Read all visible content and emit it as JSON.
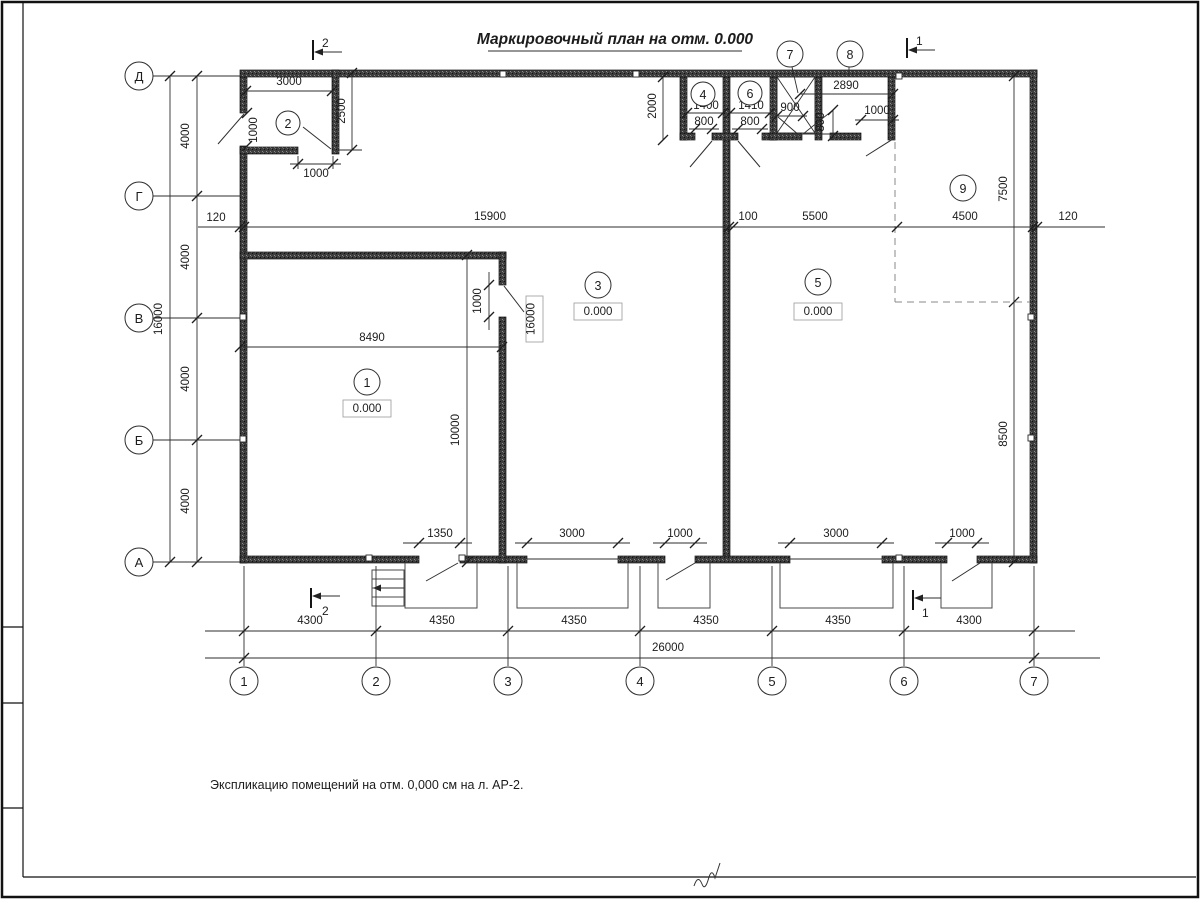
{
  "title": "Маркировочный план на отм. 0.000",
  "note": "Экспликацию помещений на отм. 0,000 см на л. АР-2.",
  "row_axes": [
    "Д",
    "Г",
    "В",
    "Б",
    "А"
  ],
  "col_axes": [
    "1",
    "2",
    "3",
    "4",
    "5",
    "6",
    "7"
  ],
  "rooms": {
    "r1": {
      "num": "1",
      "elev": "0.000"
    },
    "r2": {
      "num": "2"
    },
    "r3": {
      "num": "3",
      "elev": "0.000"
    },
    "r4": {
      "num": "4"
    },
    "r5": {
      "num": "5",
      "elev": "0.000"
    },
    "r6": {
      "num": "6"
    },
    "r7": {
      "num": "7"
    },
    "r8": {
      "num": "8"
    },
    "r9": {
      "num": "9"
    }
  },
  "sections": {
    "top_2": "2",
    "top_1": "1",
    "bottom_2": "2",
    "bottom_1": "1"
  },
  "dims": {
    "room2_width": "3000",
    "room2_depth": "2500",
    "left_wall_door": "1000",
    "room2_door": "1000",
    "top_rooms_depth": "2000",
    "room4_width": "1400",
    "room4_door": "800",
    "room6_width": "1410",
    "room6_door": "800",
    "shaft_door": "900",
    "ramp": "800",
    "room8_width": "2890",
    "room8_door": "1000",
    "room9_depth": "7500",
    "mid": [
      "120",
      "15900",
      "100",
      "5500",
      "4500",
      "120"
    ],
    "left_spans": [
      "4000",
      "4000",
      "4000",
      "4000"
    ],
    "left_total": "16000",
    "room1_width": "8490",
    "room1_door": "1000",
    "room1_depth": "10000",
    "wall_mark": "16000",
    "right_span": "8500",
    "doors": [
      "1350",
      "3000",
      "1000",
      "3000",
      "1000"
    ],
    "bottom_spans": [
      "4300",
      "4350",
      "4350",
      "4350",
      "4350",
      "4300"
    ],
    "bottom_total": "26000"
  }
}
